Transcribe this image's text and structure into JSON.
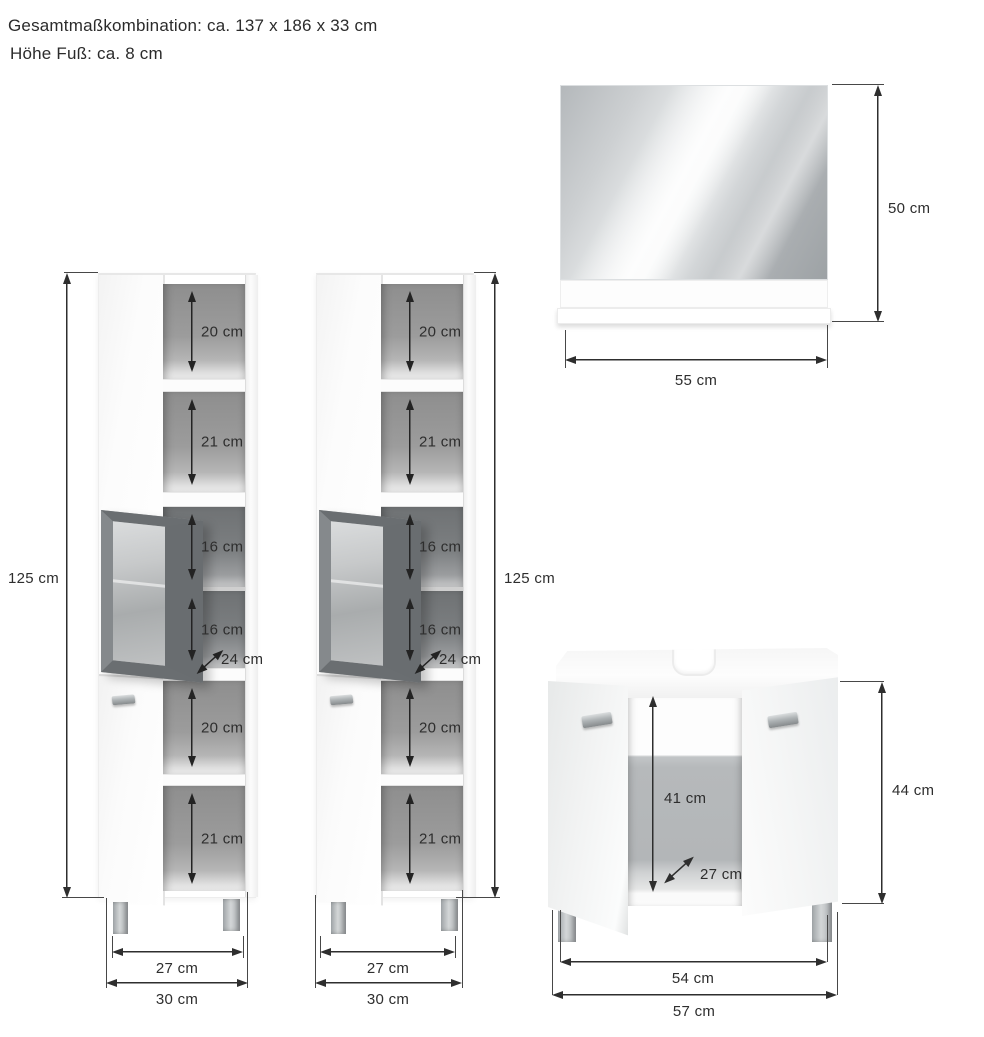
{
  "title": {
    "line1": "Gesamtmaßkombination: ca. 137 x 186 x 33 cm",
    "line2": "Höhe Fuß: ca. 8 cm"
  },
  "tall_cabinet": {
    "height": "125 cm",
    "compartments": [
      "20 cm",
      "21 cm",
      "16 cm",
      "16 cm",
      "20 cm",
      "21 cm"
    ],
    "depth": "24 cm",
    "inner_width": "27 cm",
    "outer_width": "30 cm"
  },
  "mirror": {
    "height": "50 cm",
    "width": "55 cm"
  },
  "vanity": {
    "inner_height": "41 cm",
    "depth": "27 cm",
    "height": "44 cm",
    "inner_width": "54 cm",
    "outer_width": "57 cm"
  },
  "colors": {
    "background": "#ffffff",
    "dimension_line": "#2e2e2e",
    "text": "#2b2b2b",
    "cabinet_interior": "#9a9a9a",
    "glass_door_frame": "#6a6e71",
    "metal_foot": "#aeb2b5"
  }
}
